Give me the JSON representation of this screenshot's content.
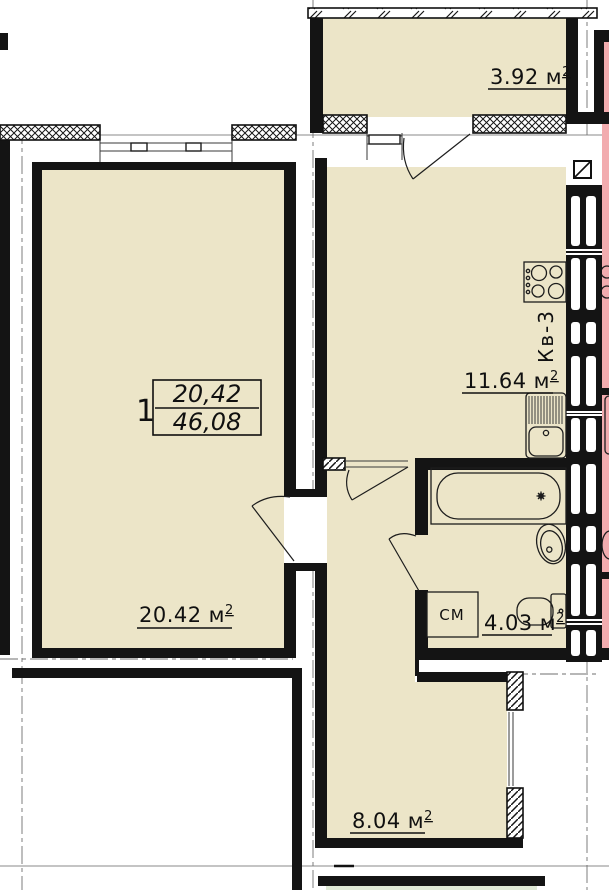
{
  "colors": {
    "floor_fill": "#ECE5C8",
    "neighbor_fill": "#F2ACAF",
    "green_fill": "#DFE9D5",
    "wall": "#141414"
  },
  "apartment": {
    "number": "1",
    "living_area": "20,42",
    "total_area": "46,08",
    "flat_ref_vertical": "Кв-3"
  },
  "rooms": {
    "balcony_top": {
      "value": "3.92",
      "unit": "м",
      "sup": "2"
    },
    "kitchen": {
      "value": "11.64",
      "unit": "м",
      "sup": "2"
    },
    "living": {
      "value": "20.42",
      "unit": "м",
      "sup": "2"
    },
    "bathroom": {
      "value": "4.03",
      "unit": "м",
      "sup": "2"
    },
    "room_bottom": {
      "value": "8.04",
      "unit": "м",
      "sup": "2"
    }
  },
  "fixtures": {
    "washing_machine_label": "СМ"
  }
}
